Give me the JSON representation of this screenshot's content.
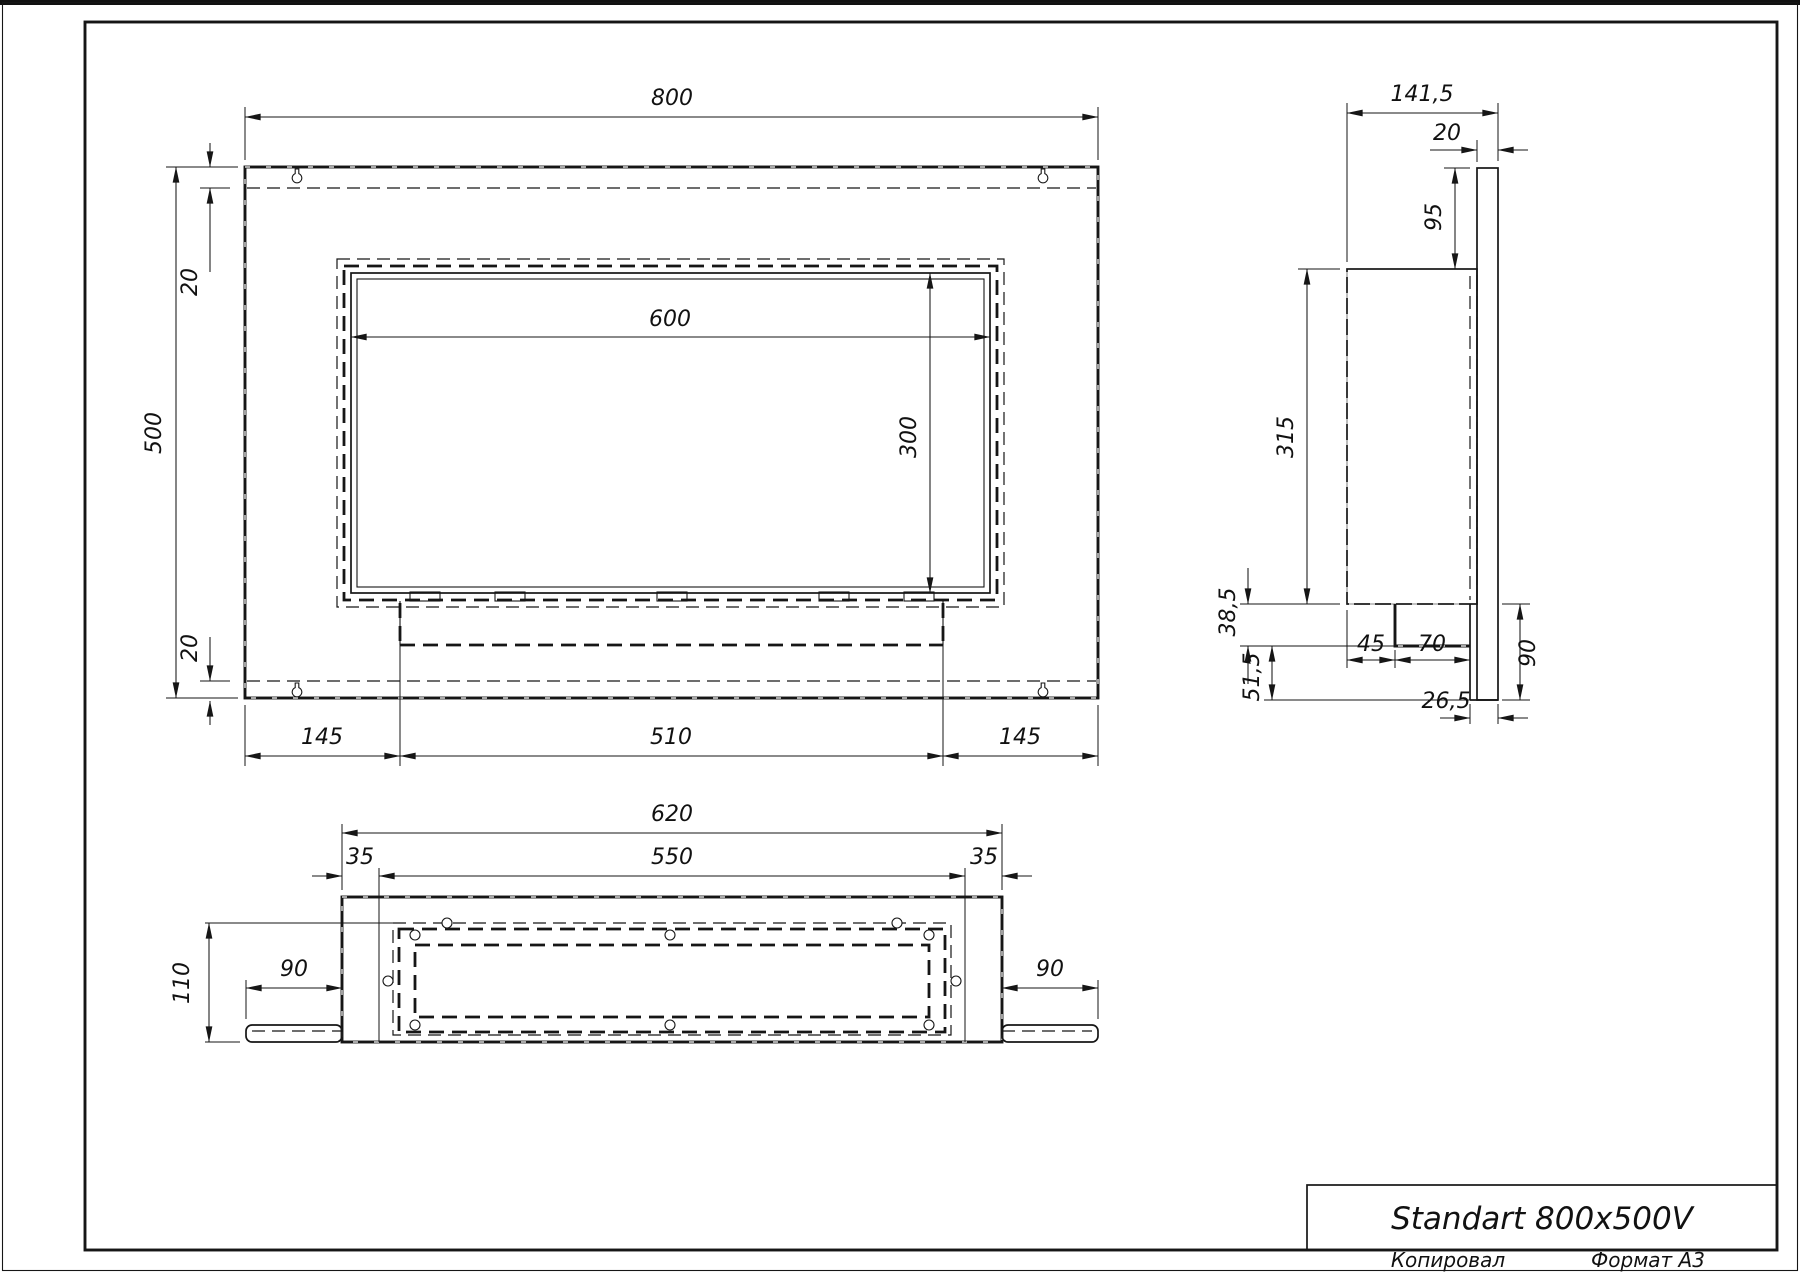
{
  "sheet": {
    "title": "Standart 800x500V",
    "footer_left": "Копировал",
    "footer_right": "Формат A3"
  },
  "front_view": {
    "dims": {
      "width": "800",
      "height": "500",
      "top_inset": "20",
      "bottom_inset": "20",
      "opening_width": "600",
      "opening_height": "300",
      "left_margin": "145",
      "burner_width": "510",
      "right_margin": "145"
    }
  },
  "bottom_view": {
    "dims": {
      "outer_width": "620",
      "inner_width": "550",
      "left_inset": "35",
      "right_inset": "35",
      "depth": "110",
      "left_wing": "90",
      "right_wing": "90"
    }
  },
  "side_view": {
    "dims": {
      "total_depth": "141,5",
      "panel_thickness": "20",
      "top_offset": "95",
      "body_height": "315",
      "step_upper": "38,5",
      "step_lower": "51,5",
      "tray_offset": "45",
      "tray_width": "70",
      "bracket_height": "90",
      "back_gap": "26,5"
    }
  }
}
